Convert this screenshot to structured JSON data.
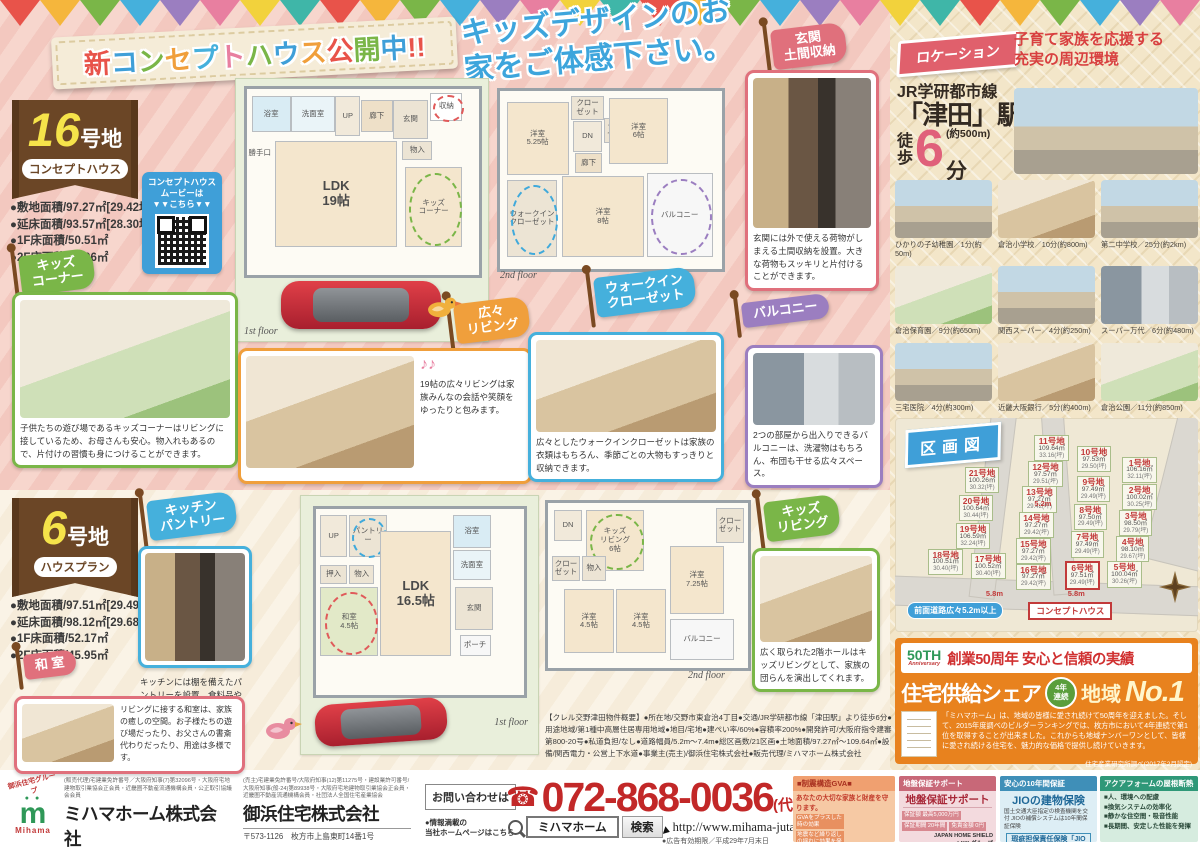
{
  "icons": {
    "phone": "☎",
    "music": "♪♪"
  },
  "bunting_colors": [
    "#e8534a",
    "#f5b63c",
    "#7ab648",
    "#45b0dc",
    "#9b7ec0",
    "#e87fa0",
    "#f2d23c",
    "#3fb6a8"
  ],
  "banner": {
    "title": "新コンセプトハウス公開中!!",
    "title_colors": [
      "#e8534a",
      "#3f9fd8",
      "#7ab648",
      "#f09f3c",
      "#45b0dc",
      "#e87fa0",
      "#7ab648",
      "#3f9fd8",
      "#f09f3c",
      "#e8534a",
      "#7ab648",
      "#3f9fd8",
      "#e8534a",
      "#e8534a"
    ],
    "subtitle": "キッズデザインのお家をご体感下さい。"
  },
  "lot16": {
    "number": "16",
    "suffix": "号地",
    "tag": "コンセプトハウス",
    "specs": [
      "●敷地面積/97.27㎡[29.42坪]",
      "●延床面積/93.57㎡[28.30坪]",
      "●1F床面積/50.51㎡",
      "●2F床面積/43.06㎡"
    ],
    "qr_caption": [
      "コンセプトハウス",
      "ムービーは",
      "▼▼こちら▼▼"
    ],
    "floor1_label": "1st floor",
    "floor2_label": "2nd floor",
    "plan1_rooms": [
      {
        "label": "浴室",
        "x": 2,
        "y": 4,
        "w": 16,
        "h": 18,
        "bg": "#d9ecf4"
      },
      {
        "label": "洗面室",
        "x": 19,
        "y": 4,
        "w": 18,
        "h": 18,
        "bg": "#eaf4f8"
      },
      {
        "label": "UP",
        "x": 38,
        "y": 4,
        "w": 10,
        "h": 20,
        "bg": "#f1e9da"
      },
      {
        "label": "廊下",
        "x": 49,
        "y": 6,
        "w": 13,
        "h": 16,
        "bg": "#eee0c8"
      },
      {
        "label": "玄関",
        "x": 63,
        "y": 6,
        "w": 14,
        "h": 20,
        "bg": "#ece4d4"
      },
      {
        "label": "収納",
        "x": 79,
        "y": 2,
        "w": 13,
        "h": 14,
        "bg": "#ffffff",
        "hl": "#e05a5a"
      },
      {
        "label": "勝手口",
        "x": 0,
        "y": 30,
        "w": 11,
        "h": 9,
        "bg": "transparent"
      },
      {
        "label": "LDK\n19帖",
        "x": 12,
        "y": 28,
        "w": 52,
        "h": 56,
        "bg": "#f4e6cd",
        "big": true
      },
      {
        "label": "物入",
        "x": 67,
        "y": 28,
        "w": 12,
        "h": 9,
        "bg": "#ece4d4"
      },
      {
        "label": "キッズ\nコーナー",
        "x": 68,
        "y": 42,
        "w": 24,
        "h": 42,
        "bg": "#f4e6cd",
        "hl": "#7ab648"
      }
    ],
    "plan2_rooms": [
      {
        "label": "洋室\n5.25帖",
        "x": 3,
        "y": 6,
        "w": 27,
        "h": 40,
        "bg": "#f4e6cd"
      },
      {
        "label": "クロー\nゼット",
        "x": 32,
        "y": 3,
        "w": 14,
        "h": 12,
        "bg": "#ece4d4"
      },
      {
        "label": "DN",
        "x": 33,
        "y": 17,
        "w": 12,
        "h": 16,
        "bg": "#f1e9da"
      },
      {
        "label": "クロー\nゼット",
        "x": 47,
        "y": 15,
        "w": 12,
        "h": 13,
        "bg": "#ece4d4"
      },
      {
        "label": "廊下",
        "x": 34,
        "y": 35,
        "w": 11,
        "h": 10,
        "bg": "#eee0c8"
      },
      {
        "label": "洋室\n6帖",
        "x": 49,
        "y": 4,
        "w": 26,
        "h": 36,
        "bg": "#f4e6cd"
      },
      {
        "label": "洋室\n8帖",
        "x": 28,
        "y": 48,
        "w": 36,
        "h": 44,
        "bg": "#f4e6cd"
      },
      {
        "label": "ウォークイン\nクローゼット",
        "x": 3,
        "y": 50,
        "w": 22,
        "h": 42,
        "bg": "#ece4d4",
        "hl": "#3fa9db"
      },
      {
        "label": "バルコニー",
        "x": 66,
        "y": 46,
        "w": 29,
        "h": 46,
        "bg": "#f7f7f7",
        "hl": "#9b7ec0"
      }
    ],
    "features": {
      "kids_corner": {
        "flag": "キッズ\nコーナー",
        "caption": "子供たちの遊び場であるキッズコーナーはリビングに接しているため、お母さんも安心。物入れもあるので、片付けの習慣も身につけることができます。"
      },
      "living": {
        "flag": "広々\nリビング",
        "caption": "19帖の広々リビングは家族みんなの会話や笑顔をゆったりと包みます。"
      },
      "wic": {
        "flag": "ウォークイン\nクローゼット",
        "caption": "広々としたウォークインクローゼットは家族の衣類はもちろん、季節ごとの大物もすっきりと収納できます。"
      },
      "balcony": {
        "flag": "バルコニー",
        "caption": "2つの部屋から出入りできるバルコニーは、洗濯物はもちろん、布団も干せる広々スペース。"
      },
      "genkan": {
        "flag": "玄関\n土間収納",
        "caption": "玄関には外で使える荷物がしまえる土間収納を設置。大きな荷物もスッキリと片付けることができます。"
      }
    }
  },
  "lot6": {
    "number": "6",
    "suffix": "号地",
    "tag": "ハウスプラン",
    "specs": [
      "●敷地面積/97.51㎡[29.49坪]",
      "●延床面積/98.12㎡[29.68坪]",
      "●1F床面積/52.17㎡",
      "●2F床面積/45.95㎡"
    ],
    "floor1_label": "1st floor",
    "floor2_label": "2nd floor",
    "plan1_rooms": [
      {
        "label": "UP",
        "x": 2,
        "y": 3,
        "w": 12,
        "h": 22,
        "bg": "#f1e9da"
      },
      {
        "label": "パントリー",
        "x": 16,
        "y": 3,
        "w": 17,
        "h": 22,
        "bg": "#ece4d4",
        "hl": "#3fa9db"
      },
      {
        "label": "浴室",
        "x": 66,
        "y": 3,
        "w": 17,
        "h": 17,
        "bg": "#d9ecf4"
      },
      {
        "label": "洗面室",
        "x": 66,
        "y": 22,
        "w": 17,
        "h": 15,
        "bg": "#eaf4f8"
      },
      {
        "label": "押入",
        "x": 2,
        "y": 30,
        "w": 12,
        "h": 9,
        "bg": "#ece4d4"
      },
      {
        "label": "物入",
        "x": 16,
        "y": 30,
        "w": 11,
        "h": 9,
        "bg": "#ece4d4"
      },
      {
        "label": "和室\n4.5帖",
        "x": 2,
        "y": 42,
        "w": 27,
        "h": 36,
        "bg": "#e2e9c8",
        "hl": "#e05a5a"
      },
      {
        "label": "LDK\n16.5帖",
        "x": 31,
        "y": 12,
        "w": 33,
        "h": 66,
        "bg": "#f4e6cd",
        "big": true
      },
      {
        "label": "玄関",
        "x": 67,
        "y": 42,
        "w": 17,
        "h": 22,
        "bg": "#ece4d4"
      },
      {
        "label": "ポーチ",
        "x": 69,
        "y": 68,
        "w": 14,
        "h": 10,
        "bg": "#f7f7f7"
      }
    ],
    "plan2_rooms": [
      {
        "label": "DN",
        "x": 3,
        "y": 4,
        "w": 13,
        "h": 18,
        "bg": "#f1e9da"
      },
      {
        "label": "キッズ\nリビング\n6帖",
        "x": 19,
        "y": 4,
        "w": 28,
        "h": 36,
        "bg": "#f4e6cd",
        "hl": "#7ab648"
      },
      {
        "label": "クロー\nゼット",
        "x": 84,
        "y": 3,
        "w": 13,
        "h": 20,
        "bg": "#ece4d4"
      },
      {
        "label": "クロー\nゼット",
        "x": 2,
        "y": 32,
        "w": 13,
        "h": 14,
        "bg": "#ece4d4"
      },
      {
        "label": "物入",
        "x": 17,
        "y": 32,
        "w": 11,
        "h": 14,
        "bg": "#ece4d4"
      },
      {
        "label": "洋室\n4.5帖",
        "x": 8,
        "y": 52,
        "w": 24,
        "h": 38,
        "bg": "#f4e6cd"
      },
      {
        "label": "洋室\n4.5帖",
        "x": 34,
        "y": 52,
        "w": 24,
        "h": 38,
        "bg": "#f4e6cd"
      },
      {
        "label": "洋室\n7.25帖",
        "x": 61,
        "y": 26,
        "w": 26,
        "h": 40,
        "bg": "#f4e6cd"
      },
      {
        "label": "バルコニー",
        "x": 61,
        "y": 70,
        "w": 31,
        "h": 24,
        "bg": "#f7f7f7"
      }
    ],
    "features": {
      "pantry": {
        "flag": "キッチン\nパントリー",
        "caption": "キッチンには棚を備えたパントリーを設置。食料品や調味料などを大量に買い込んでも十分しまえる収納力です。"
      },
      "washitsu": {
        "flag": "和 室",
        "caption": "リビングに接する和室は、家族の癒しの空間。お子様たちの遊び場だったり、お父さんの書斎代わりだったり、用途は多様です。"
      },
      "kids_living": {
        "flag": "キッズ\nリビング",
        "caption": "広く取られた2階ホールはキッズリビングとして、家族の団らんを演出してくれます。"
      }
    }
  },
  "location": {
    "flag": "ロケーション",
    "headline_1": "子育て家族を応援する",
    "headline_2": "充実の周辺環境",
    "rail": "JR学研都市線",
    "station": "「津田」駅",
    "walk_1": "徒",
    "walk_2": "歩",
    "minutes": "6",
    "minutes_unit": "分",
    "distance": "(約500m)",
    "spots": [
      "ひかりの子幼稚園／1分(約50m)",
      "倉治小学校／10分(約800m)",
      "第二中学校／25分(約2km)",
      "倉治保育園／9分(約650m)",
      "関西スーパー／4分(約250m)",
      "スーパー万代／6分(約480m)",
      "三宅医院／4分(約300m)",
      "近畿大阪銀行／5分(約400m)",
      "倉治公園／11分(約850m)"
    ]
  },
  "map": {
    "title": "区画図",
    "note_road": "前面道路広々5.2m以上",
    "note_concept": "コンセプトハウス",
    "dim_a": "5.2m",
    "dim_b": "5.8m",
    "dim_c": "5.8m",
    "lots": [
      {
        "no": "21号地",
        "area": "100.26㎡",
        "tsubo": "30.32(坪)",
        "x": 23,
        "y": 23
      },
      {
        "no": "20号地",
        "area": "100.64㎡",
        "tsubo": "30.44(坪)",
        "x": 21,
        "y": 36
      },
      {
        "no": "19号地",
        "area": "106.59㎡",
        "tsubo": "32.24(坪)",
        "x": 20,
        "y": 49
      },
      {
        "no": "18号地",
        "area": "100.51㎡",
        "tsubo": "30.40(坪)",
        "x": 11,
        "y": 61
      },
      {
        "no": "17号地",
        "area": "100.52㎡",
        "tsubo": "30.40(坪)",
        "x": 25,
        "y": 63
      },
      {
        "no": "11号地",
        "area": "109.64㎡",
        "tsubo": "33.16(坪)",
        "x": 46,
        "y": 8
      },
      {
        "no": "12号地",
        "area": "97.57㎡",
        "tsubo": "29.51(坪)",
        "x": 44,
        "y": 20
      },
      {
        "no": "13号地",
        "area": "97.27㎡",
        "tsubo": "29.42(坪)",
        "x": 42,
        "y": 32
      },
      {
        "no": "14号地",
        "area": "97.27㎡",
        "tsubo": "29.42(坪)",
        "x": 41,
        "y": 44
      },
      {
        "no": "15号地",
        "area": "97.27㎡",
        "tsubo": "29.42(坪)",
        "x": 40,
        "y": 56
      },
      {
        "no": "16号地",
        "area": "97.27㎡",
        "tsubo": "29.42(坪)",
        "x": 40,
        "y": 68
      },
      {
        "no": "10号地",
        "area": "97.53㎡",
        "tsubo": "29.50(坪)",
        "x": 60,
        "y": 13
      },
      {
        "no": "1号地",
        "area": "106.16㎡",
        "tsubo": "32.11(坪)",
        "x": 75,
        "y": 18
      },
      {
        "no": "9号地",
        "area": "97.49㎡",
        "tsubo": "29.49(坪)",
        "x": 60,
        "y": 27
      },
      {
        "no": "2号地",
        "area": "100.02㎡",
        "tsubo": "30.25(坪)",
        "x": 75,
        "y": 31
      },
      {
        "no": "8号地",
        "area": "97.50㎡",
        "tsubo": "29.49(坪)",
        "x": 59,
        "y": 40
      },
      {
        "no": "3号地",
        "area": "98.50㎡",
        "tsubo": "29.79(坪)",
        "x": 74,
        "y": 43
      },
      {
        "no": "7号地",
        "area": "97.49㎡",
        "tsubo": "29.49(坪)",
        "x": 58,
        "y": 53
      },
      {
        "no": "4号地",
        "area": "98.10㎡",
        "tsubo": "29.67(坪)",
        "x": 73,
        "y": 55
      },
      {
        "no": "6号地",
        "area": "97.51㎡",
        "tsubo": "29.49(坪)",
        "x": 56,
        "y": 67,
        "concept": true
      },
      {
        "no": "5号地",
        "area": "100.04㎡",
        "tsubo": "30.26(坪)",
        "x": 70,
        "y": 67
      }
    ]
  },
  "anniversary": {
    "logo_1": "50TH",
    "logo_2": "Anniversary",
    "heading": "創業50周年 安心と信頼の実績",
    "share": "住宅供給シェア",
    "badge_1": "4年",
    "badge_2": "連続",
    "no1_a": "地域",
    "no1_b": "No.1",
    "body": "「ミハマホーム」は、地域の皆様に愛され続けて50周年を迎えました。そして、2015年度調べのビルダーランキングでは、枚方市において4年連続で第1位を取得することが出来ました。これからも地域ナンバーワンとして、皆様に愛され続ける住宅を、魅力的な価格で提供し続けていきます。",
    "source": "住宅産業研究所調べ(2017年2月認定)"
  },
  "overview": "【クレル交野津田物件概要】●所在地/交野市東倉治4丁目●交通/JR学研都市線「津田駅」より徒歩6分●用途地域/第1種中高層住居専用地域●地目/宅地●建ぺい率/60%●容積率200%●開発許可/大阪府指令建審第800-20号●私道負担/なし●道路幅員/5.2m〜7.4m●総区画数/21区画●土地面積/97.27㎡〜109.64㎡●設備/関西電力・公営上下水道●事業主(売主)/御浜住宅株式会社●販売代理/ミハマホーム株式会社",
  "footer": {
    "group": "御浜住宅グループ",
    "logo_m": "m",
    "logo": "Mihama",
    "co1": {
      "license": "(販売代理)宅建業免許番号／大阪府知事(7)第32096号・大阪府宅地建物取引業協会正会員・近畿圏不動産流通機構会員・公正取引協議会会員",
      "name": "ミハマホーム株式会社",
      "addr": "〒573-1126　枚方市上島東町14番1号"
    },
    "co2": {
      "license": "(売主)宅建業免許番号/大阪府知事(12)第11275号・建設業許可番号/大阪府知事(般-24)第89938号・大阪府宅地建物取引業協会正会員・近畿圏不動産流通機構会員・社団法人全国住宅産業協会",
      "name": "御浜住宅株式会社",
      "addr": "〒573-1126　枚方市上島東町14番1号"
    },
    "contact": "お問い合わせは",
    "phone": "072-868-0036",
    "phone_suffix": "(代)",
    "hp_note_1": "●情報満載の",
    "hp_note_2": "当社ホームページはこちら",
    "search_value": "ミハマホーム",
    "search_button": "検索",
    "url": "http://www.mihama-jutaku.co.jp",
    "expiry": "●広告有効期限／平成29年7月末日",
    "gva": {
      "header": "■制震構造GVA■",
      "lead": "あなたの大切な家族と財産を守ります。",
      "items": [
        "GVAをプラスした時の効果",
        "地震など繰り返しの揺れに効果を発揮",
        "揺れを約50%軽減",
        "建物の耐久性や寿命を高めます。"
      ]
    },
    "jiban": {
      "header": "地盤保証サポート",
      "title": "地盤保証サポート",
      "cells": [
        {
          "k": "保証額",
          "v": "最高5,000万円"
        },
        {
          "k": "保証期間",
          "v": "20年間"
        },
        {
          "k": "免責金額",
          "v": "0円"
        }
      ],
      "brand": "JAPAN HOME SHIELD",
      "brand2": "LIXILグループ"
    },
    "jio": {
      "header": "安心の10年間保証",
      "title": "JIOの建物保険",
      "body": "国土交通大臣指定の検査機関を交付 JIOの補償システムは10年間保証保険",
      "box": "瑕疵担保責任保険「JIOわが家の保険」"
    },
    "aqua": {
      "header": "アクアフォームの屋根断熱",
      "items": [
        "■人、環境への配慮",
        "■換気システムの効率化",
        "■静かな住空間・吸音性能",
        "■長期間、安定した性能を発揮"
      ]
    }
  }
}
